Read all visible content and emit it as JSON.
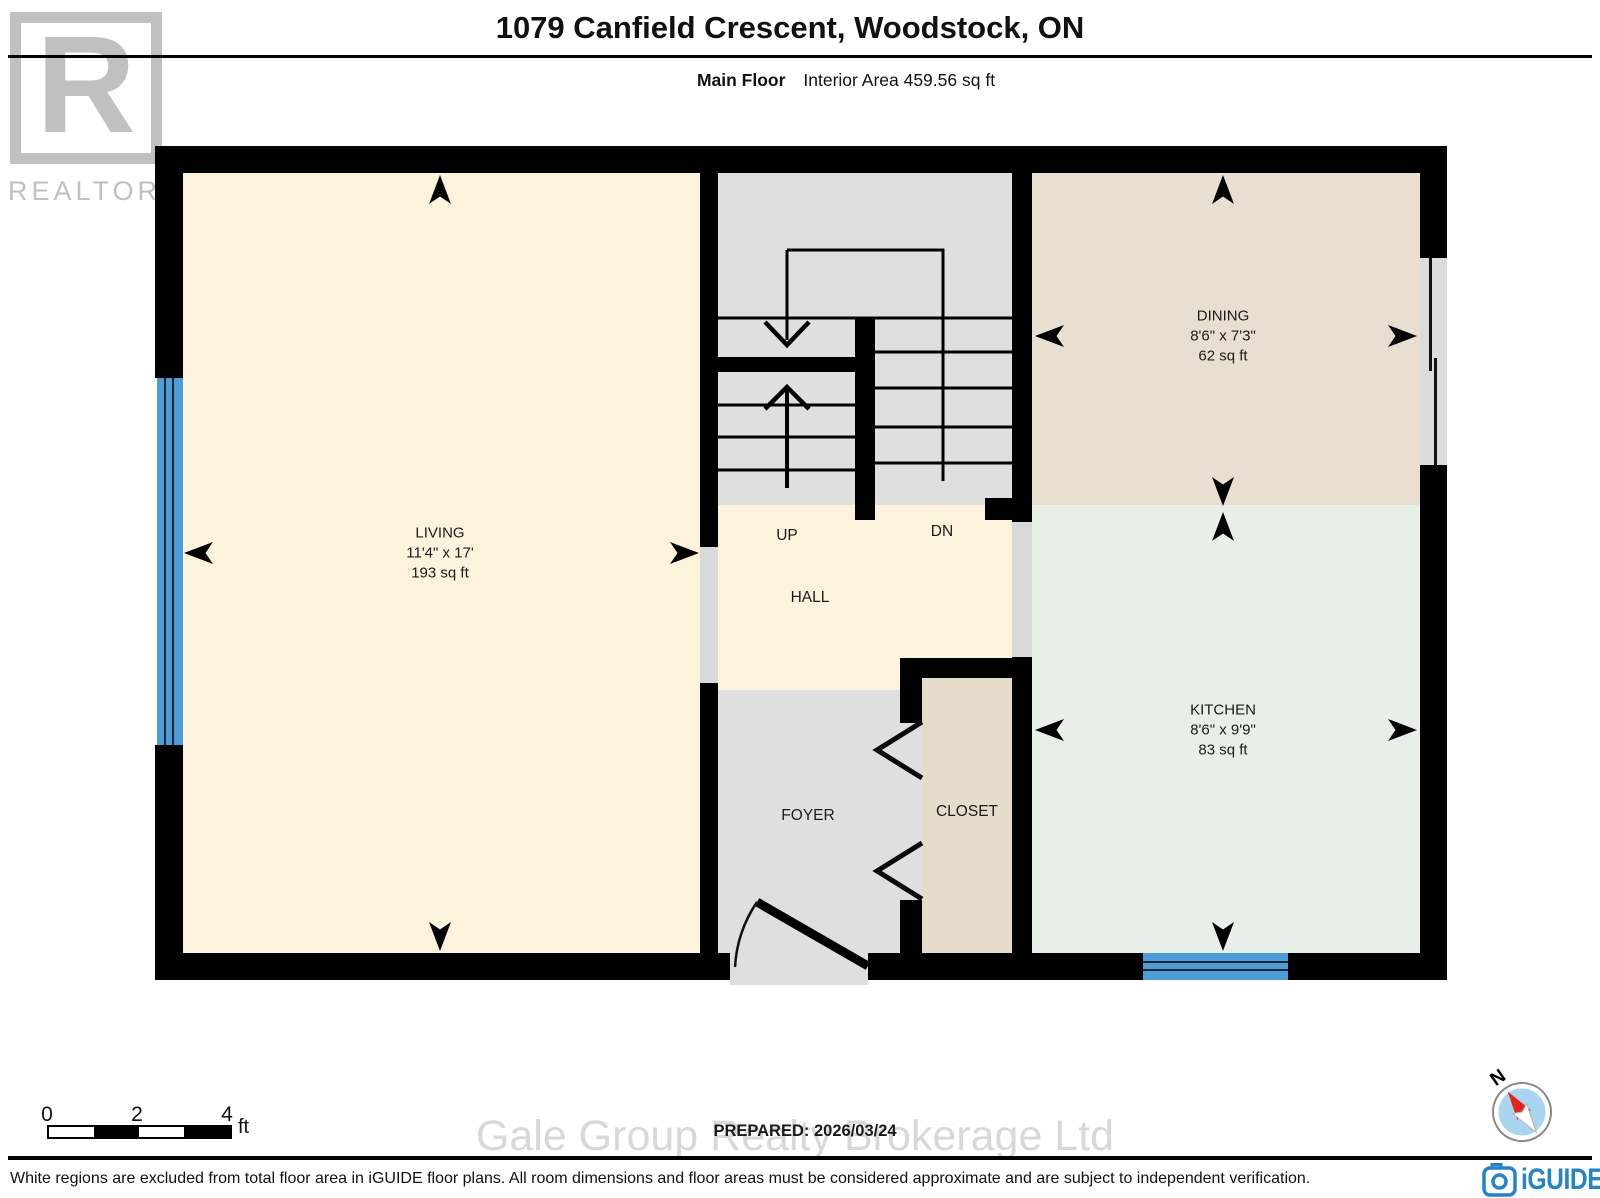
{
  "header": {
    "title": "1079 Canfield Crescent, Woodstock, ON",
    "floor_label": "Main Floor",
    "area_label": "Interior Area 459.56 sq ft"
  },
  "branding": {
    "realtor_letter": "R",
    "realtor_label": "REALTOR",
    "realtor_reg": "®",
    "iguide_label": "iGUIDE",
    "watermark": "Gale Group Realty Brokerage Ltd"
  },
  "rooms": {
    "living": {
      "name": "LIVING",
      "dims": "11'4\" x 17'",
      "area": "193 sq ft"
    },
    "dining": {
      "name": "DINING",
      "dims": "8'6\" x 7'3\"",
      "area": "62 sq ft"
    },
    "kitchen": {
      "name": "KITCHEN",
      "dims": "8'6\" x 9'9\"",
      "area": "83 sq ft"
    },
    "hall": {
      "name": "HALL"
    },
    "foyer": {
      "name": "FOYER"
    },
    "closet": {
      "name": "CLOSET"
    },
    "stairs": {
      "up": "UP",
      "down": "DN"
    }
  },
  "scale_bar": {
    "ticks": [
      "0",
      "2",
      "4"
    ],
    "unit": "ft"
  },
  "compass": {
    "label": "N"
  },
  "footer": {
    "prepared": "PREPARED: 2026/03/24",
    "disclaimer": "White regions are excluded from total floor area in iGUIDE floor plans. All room dimensions and floor areas must be considered approximate and are subject to independent verification."
  },
  "colors": {
    "wall": "#000000",
    "living_hall_fill": "#FBF3DB",
    "dining_fill": "#E9DFD1",
    "kitchen_fill": "#E7EFE8",
    "closet_fill": "#E6DCCC",
    "circulation_fill": "#DFDFDF",
    "opening_fill": "#D9D9D9",
    "window_blue": "#4E9CD5",
    "iguide_blue": "#2583C6",
    "compass_red": "#E62519",
    "compass_face": "#A9D5F1",
    "watermark_gray": "#D8D8D8",
    "realtor_gray": "#C0C0C0"
  }
}
